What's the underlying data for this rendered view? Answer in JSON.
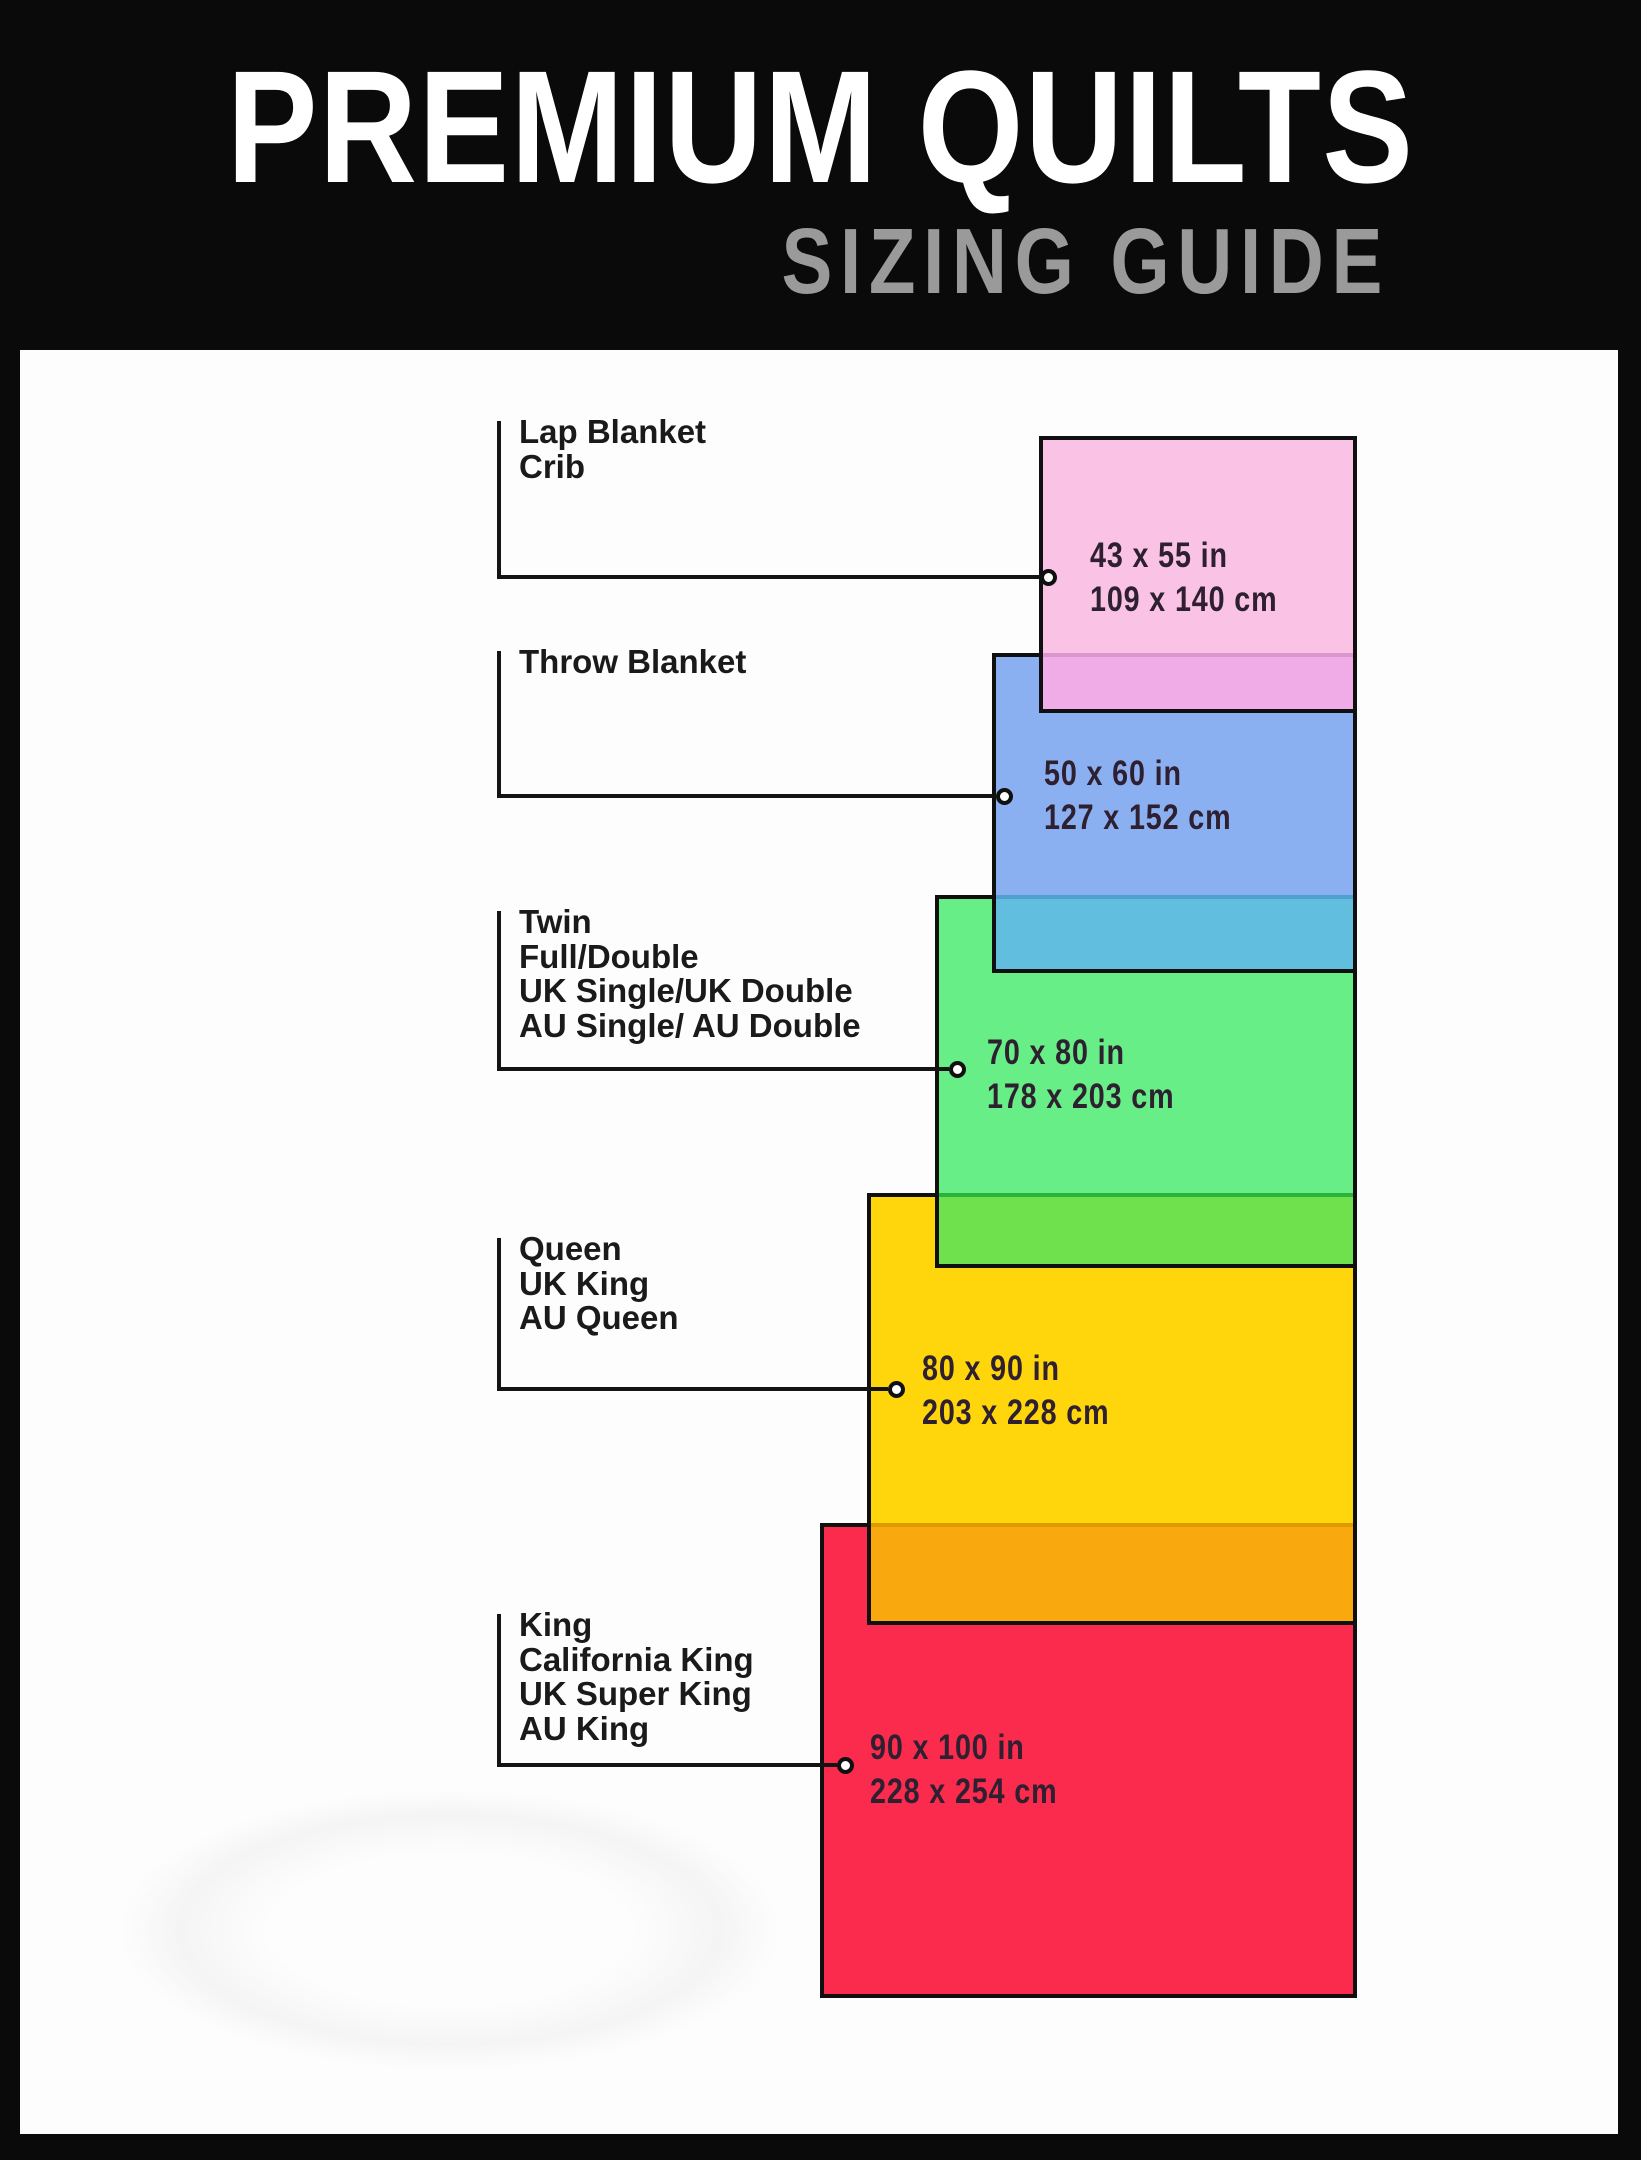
{
  "header": {
    "title": "PREMIUM QUILTS",
    "subtitle": "SIZING GUIDE"
  },
  "colors": {
    "frame": "#0a0a0a",
    "panel": "#fdfdfd",
    "title": "#ffffff",
    "subtitle": "#9a9a9a",
    "outline": "#101010",
    "label_text": "#1a1a1a",
    "dimension_text": "#2e2030"
  },
  "diagram": {
    "right_edge": 1357,
    "border_width": 4,
    "sizes": [
      {
        "id": "lap-blanket-crib",
        "labels": [
          "Lap Blanket",
          "Crib"
        ],
        "inches": "43 x 55 in",
        "cm": "109 x 140 cm",
        "fill": "#fac3e5",
        "rect": {
          "left": 1039,
          "top": 436,
          "width": 318,
          "height": 277
        },
        "label_top": 415,
        "pointer_y": 577,
        "circle_cx": 1048,
        "text_left": 1090,
        "text_top": 534
      },
      {
        "id": "throw-blanket",
        "labels": [
          "Throw Blanket"
        ],
        "inches": "50 x 60 in",
        "cm": "127 x 152 cm",
        "fill": "#8bb0f1",
        "rect": {
          "left": 992,
          "top": 653,
          "width": 365,
          "height": 320
        },
        "label_top": 645,
        "pointer_y": 796,
        "circle_cx": 1004,
        "text_left": 1044,
        "text_top": 752
      },
      {
        "id": "twin-full-double",
        "labels": [
          "Twin",
          "Full/Double",
          "UK Single/UK Double",
          "AU Single/ AU Double"
        ],
        "inches": "70 x 80 in",
        "cm": "178 x 203 cm",
        "fill": "#68ee87",
        "rect": {
          "left": 935,
          "top": 895,
          "width": 422,
          "height": 373
        },
        "label_top": 905,
        "pointer_y": 1069,
        "circle_cx": 957,
        "text_left": 987,
        "text_top": 1031
      },
      {
        "id": "queen-uk-king",
        "labels": [
          "Queen",
          "UK King",
          "AU Queen"
        ],
        "inches": "80 x 90 in",
        "cm": "203 x 228 cm",
        "fill": "#ffd60c",
        "rect": {
          "left": 867,
          "top": 1193,
          "width": 490,
          "height": 432
        },
        "label_top": 1232,
        "pointer_y": 1389,
        "circle_cx": 896,
        "text_left": 922,
        "text_top": 1347
      },
      {
        "id": "king-california-king",
        "labels": [
          "King",
          "California King",
          "UK Super King",
          "AU King"
        ],
        "inches": "90 x 100 in",
        "cm": "228 x 254 cm",
        "fill": "#fb2b4e",
        "rect": {
          "left": 820,
          "top": 1523,
          "width": 537,
          "height": 475
        },
        "label_top": 1608,
        "pointer_y": 1765,
        "circle_cx": 845,
        "text_left": 870,
        "text_top": 1726
      }
    ],
    "overlaps": [
      {
        "band": "#eface7",
        "line": "#dc96ce"
      },
      {
        "band": "#61bede",
        "line": "#4fa0d0"
      },
      {
        "band": "#6fe14c",
        "line": "#2bb23c"
      },
      {
        "band": "#f9a80d",
        "line": "#dd9b00"
      }
    ]
  }
}
